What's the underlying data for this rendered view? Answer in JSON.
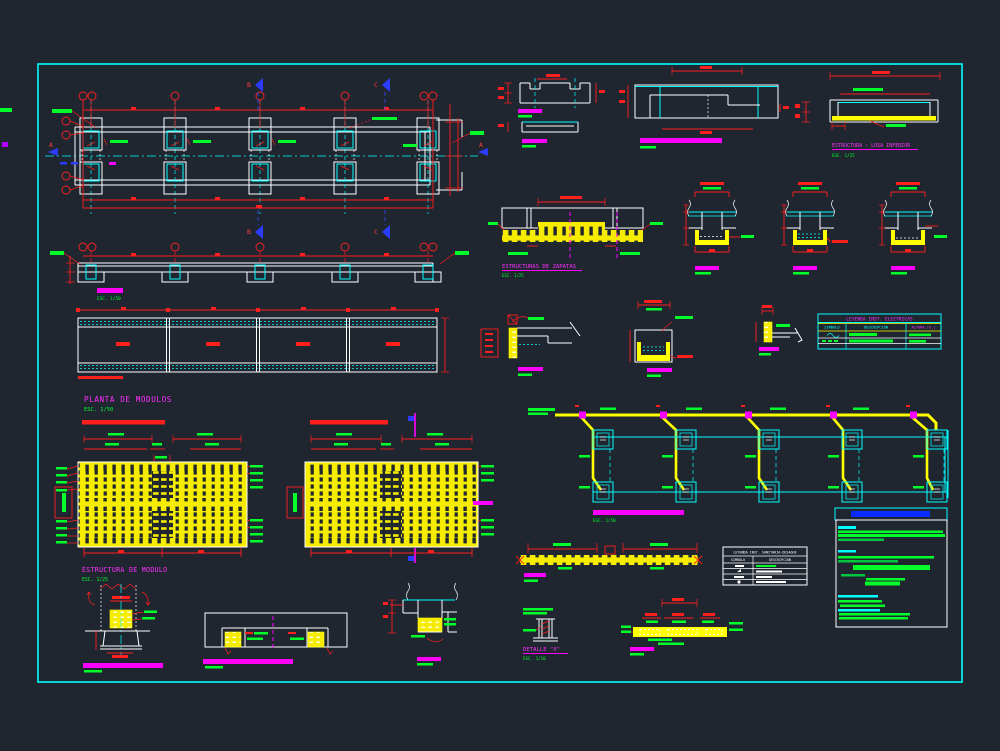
{
  "sheet": {
    "bg": "#1f2630",
    "frame_color": "#00ffff",
    "palette": {
      "structure_lines": "#ffffff",
      "dimension_red": "#ff1f1f",
      "axis_cyan": "#00ffff",
      "hatch_yellow": "#ffff00",
      "label_green": "#00ff2a",
      "title_magenta": "#ff2fff",
      "section_blue": "#2b3cff",
      "notes_title_blue": "#0a2bff",
      "scalebar_magenta": "#ff00ff"
    }
  },
  "titles": {
    "planta_modulos": "PLANTA DE  MODULOS",
    "estructura_modulo": "ESTRUCTURA DE MODULO",
    "estructuras_zapatas": "ESTRUCTURAS DE ZAPATAS",
    "losa_inferior": "ESTRUCTURA : LOSA INFERIOR",
    "detalle_x": "DETALLE \"X\"",
    "esc_1_50": "ESC. 1/50",
    "esc_1_25": "ESC. 1/25",
    "esc_1_10": "ESC. 1/10"
  },
  "section_markers": {
    "a": "A",
    "b": "B",
    "c": "C"
  },
  "legend_electrica": {
    "title": "LEYENDA INST. ELECTRICAS",
    "columns": {
      "simbolo": "SIMBOLO",
      "descripcion": "DESCRIPCION",
      "altura": "ALTURA (h.)"
    }
  },
  "legend_sanitaria": {
    "title": "LEYENDA INST. SANITARIA-DESAGUE",
    "columns": {
      "simbolo": "SIMBOLO",
      "descripcion": "DESCRIPCION"
    }
  }
}
